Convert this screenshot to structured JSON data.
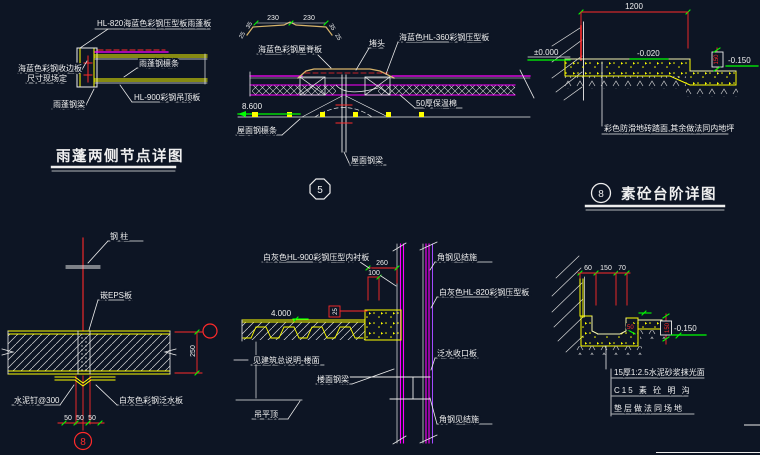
{
  "background": "#0d1524",
  "palette": {
    "line": "#ededed",
    "yellow": "#ffff00",
    "magenta": "#ff00ff",
    "red": "#ff2a2a",
    "green": "#00ff00",
    "tan": "#d8b46a",
    "violet": "#a24bff"
  },
  "canopy_detail": {
    "title": "雨蓬两侧节点详图",
    "labels": {
      "panel": "HL-820海蓝色彩钢压型板雨蓬板",
      "edge_line1": "海蓝色彩钢收边板",
      "edge_line2": "尺寸现场定",
      "purlin": "雨蓬钢檩条",
      "ceiling": "HL-900彩钢吊顶板",
      "beam": "雨蓬钢梁"
    }
  },
  "ridge_detail": {
    "bubble": "5",
    "elevation": "8.600",
    "dims": {
      "d230a": "230",
      "d230b": "230",
      "d35a": "35",
      "d35b": "35",
      "d25a": "25",
      "d25b": "25"
    },
    "labels": {
      "ridge_cap": "海蓝色彩钢屋脊板",
      "end_plug": "堵头",
      "roof_panel": "海蓝色HL-360彩钢压型板",
      "insulation": "50厚保温棉",
      "purlin": "屋面钢檩条",
      "beam": "屋面钢梁"
    }
  },
  "step_detail": {
    "bubble": "8",
    "title": "素砼台阶详图",
    "dims": {
      "width": "1200",
      "riser": "150"
    },
    "elevations": {
      "zero": "±0.000",
      "top": "-0.020",
      "bottom": "-0.150"
    },
    "note": "彩色防滑地砖踏面,其余做法同内地坪"
  },
  "wall_joint_detail": {
    "bubble": "8",
    "dims": {
      "d50a": "50",
      "d50b": "50",
      "d50c": "50",
      "thickness": "250"
    },
    "labels": {
      "column": "钢 柱",
      "eps": "嵌EPS板",
      "nail": "水泥钉@300",
      "flashing": "白灰色彩钢泛水板"
    }
  },
  "floor_edge_detail": {
    "elevation": "4.000",
    "dims": {
      "d260": "260",
      "d100": "100",
      "d25": "25"
    },
    "labels": {
      "liner": "白灰色HL-900彩钢压型内衬板",
      "angle_top": "角钢见结施",
      "wall_panel": "白灰色HL-820彩钢压型板",
      "closure": "泛水收口板",
      "beam": "楼面钢梁",
      "ceiling": "吊平顶",
      "floor_note": "见建筑总说明-楼面",
      "angle_bottom": "角钢见结施"
    }
  },
  "gutter_detail": {
    "dims": {
      "d60": "60",
      "d150": "150",
      "d70": "70",
      "d50": "50",
      "depth": "150"
    },
    "elevation": "-0.150",
    "notes": {
      "line1": "15厚1:2.5水泥砂浆抹光面",
      "line2": "C15 素 砼 明 沟",
      "line3": "垫层做法同场地"
    }
  }
}
